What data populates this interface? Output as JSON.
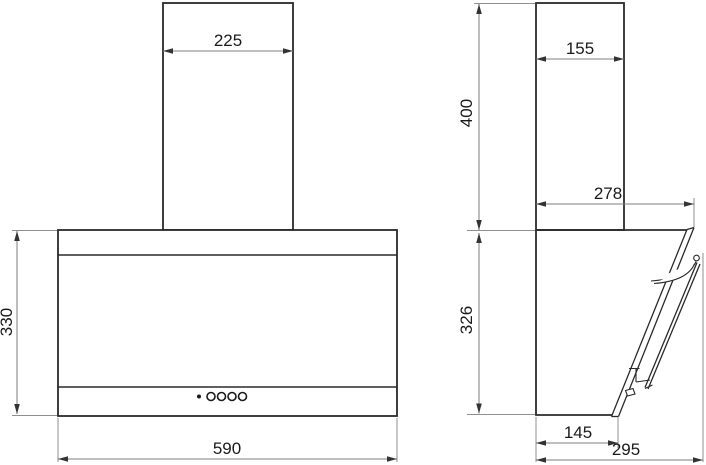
{
  "drawing": {
    "type": "technical-dimension-drawing",
    "subject": "wall-mounted cooker hood, front and side orthographic views",
    "units": "mm",
    "colors": {
      "background": "#ffffff",
      "outline": "#2a2a2a",
      "dimension_line": "#7d7d7d",
      "extension_line": "#8f8f8f",
      "text": "#1a1a1a"
    },
    "front_view": {
      "duct_width": "225",
      "body_height": "330",
      "body_width": "590",
      "control_buttons_count": 4
    },
    "side_view": {
      "duct_depth": "155",
      "duct_height": "400",
      "upper_depth": "278",
      "body_height": "326",
      "body_bottom_depth": "145",
      "overall_depth": "295"
    }
  }
}
